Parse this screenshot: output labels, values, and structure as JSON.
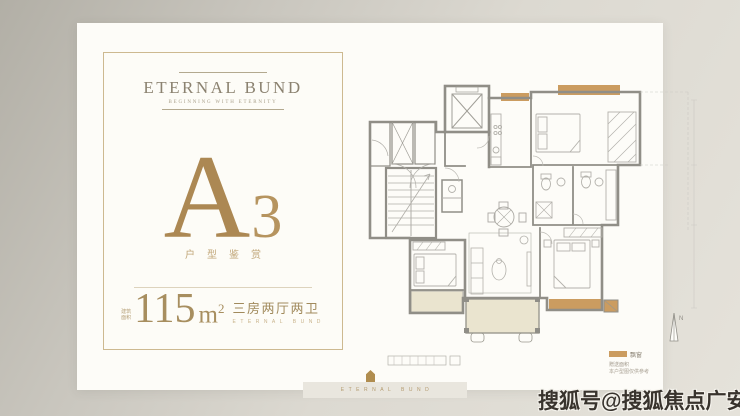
{
  "brand": {
    "logo": "ETERNAL BUND",
    "tagline": "BEGINNING WITH ETERNITY",
    "unit_letter": "A",
    "unit_number": "3",
    "unit_caption": "户型鉴赏"
  },
  "area": {
    "prefix_top": "建筑",
    "prefix_bottom": "面积",
    "value": "115",
    "unit": "m",
    "sup": "2",
    "layout": "三房两厅两卫",
    "layout_sub": "ETERNAL BUND"
  },
  "floorplan": {
    "north_label": "N",
    "legend_swatch_label": "飘窗",
    "legend_line2": "赠送面积",
    "legend_line3": "本户型图仅供参考"
  },
  "footer": {
    "emblem_text": "ETERNAL BUND"
  },
  "watermark": {
    "text": "搜狐号@搜狐焦点广安站"
  },
  "colors": {
    "gold": "#ac8853",
    "bay_window_tan": "#cb9c60",
    "balcony_beige": "#eae4cf",
    "wall_gray": "#908e87"
  }
}
